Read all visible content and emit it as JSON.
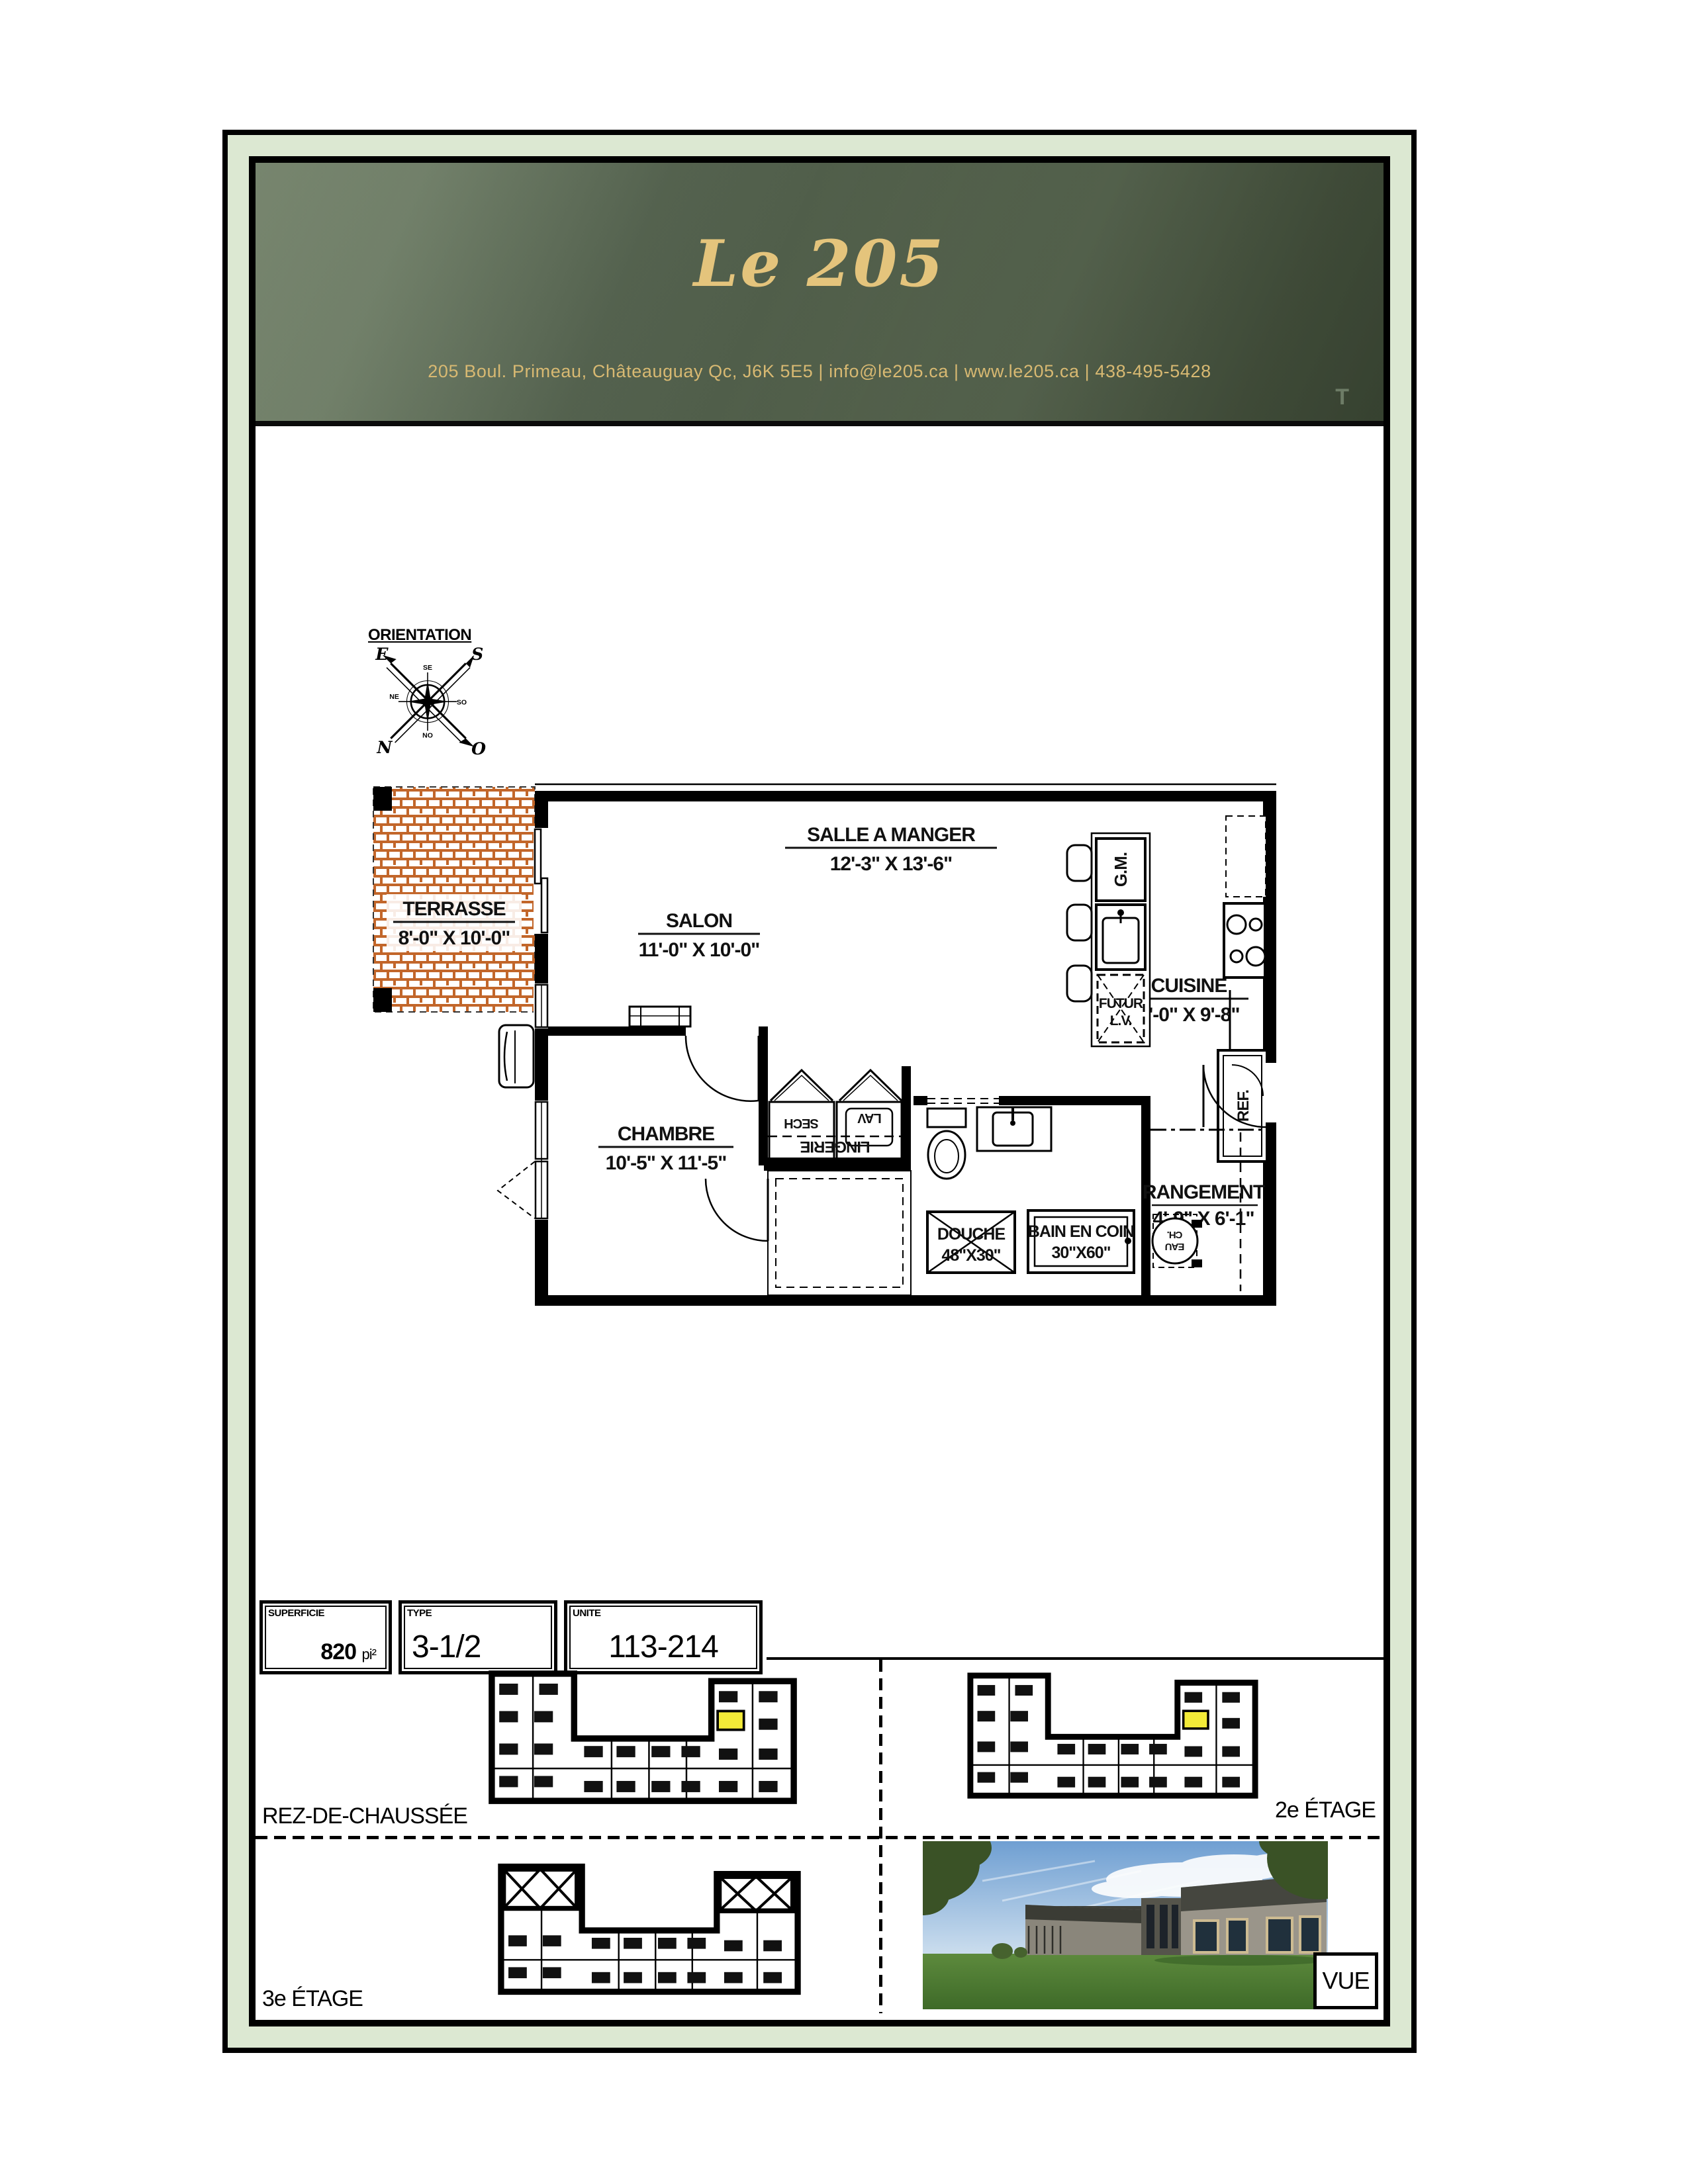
{
  "header": {
    "title": "Le 205",
    "address_line": "205 Boul. Primeau, Châteauguay Qc, J6K 5E5   |   info@le205.ca   |   www.le205.ca   |   438-495-5428",
    "corner_mark": "T"
  },
  "orientation": {
    "label": "ORIENTATION",
    "north": "N",
    "south": "S",
    "east": "E",
    "west": "O",
    "tick_top": "SE",
    "tick_right": "SO",
    "tick_bottom": "NO",
    "tick_left": "NE"
  },
  "plan": {
    "rooms": {
      "terrasse": {
        "name": "TERRASSE",
        "dims": "8'-0\" X 10'-0\""
      },
      "salon": {
        "name": "SALON",
        "dims": "11'-0\" X 10'-0\""
      },
      "salle_a_manger": {
        "name": "SALLE A MANGER",
        "dims": "12'-3\" X 13'-6\""
      },
      "cuisine": {
        "name": "CUISINE",
        "dims": "8'-0\" X 9'-8\""
      },
      "chambre": {
        "name": "CHAMBRE",
        "dims": "10'-5\" X 11'-5\""
      },
      "rangement": {
        "name": "RANGEMENT",
        "dims": "4'-9\" X 6'-1\""
      },
      "douche": {
        "name": "DOUCHE",
        "dims": "48\"X30\""
      },
      "bain": {
        "name": "BAIN EN COIN",
        "dims": "30\"X60\""
      }
    },
    "fixtures": {
      "gm": "G.M.",
      "futur1": "FUTUR",
      "futur2": "L.V.",
      "ref": "REF.",
      "sech": "SECH",
      "lav": "LAV",
      "lingerie": "LINGERIE",
      "ch": "CH.",
      "eau": "EAU"
    }
  },
  "info_boxes": {
    "superficie": {
      "label": "SUPERFICIE",
      "value": "820",
      "unit": "pi²"
    },
    "type": {
      "label": "TYPE",
      "value": "3-1/2"
    },
    "unite": {
      "label": "UNITE",
      "value": "113-214"
    }
  },
  "levels": {
    "rdc": "REZ-DE-CHAUSSÉE",
    "etage2": "2e ÉTAGE",
    "etage3": "3e ÉTAGE",
    "vue": "VUE"
  },
  "colors": {
    "header_green": "#4d5b48",
    "gold": "#e4c47c",
    "frame_band": "#dce8d2",
    "brick": "#c2662a",
    "highlight": "#f3eb38"
  }
}
